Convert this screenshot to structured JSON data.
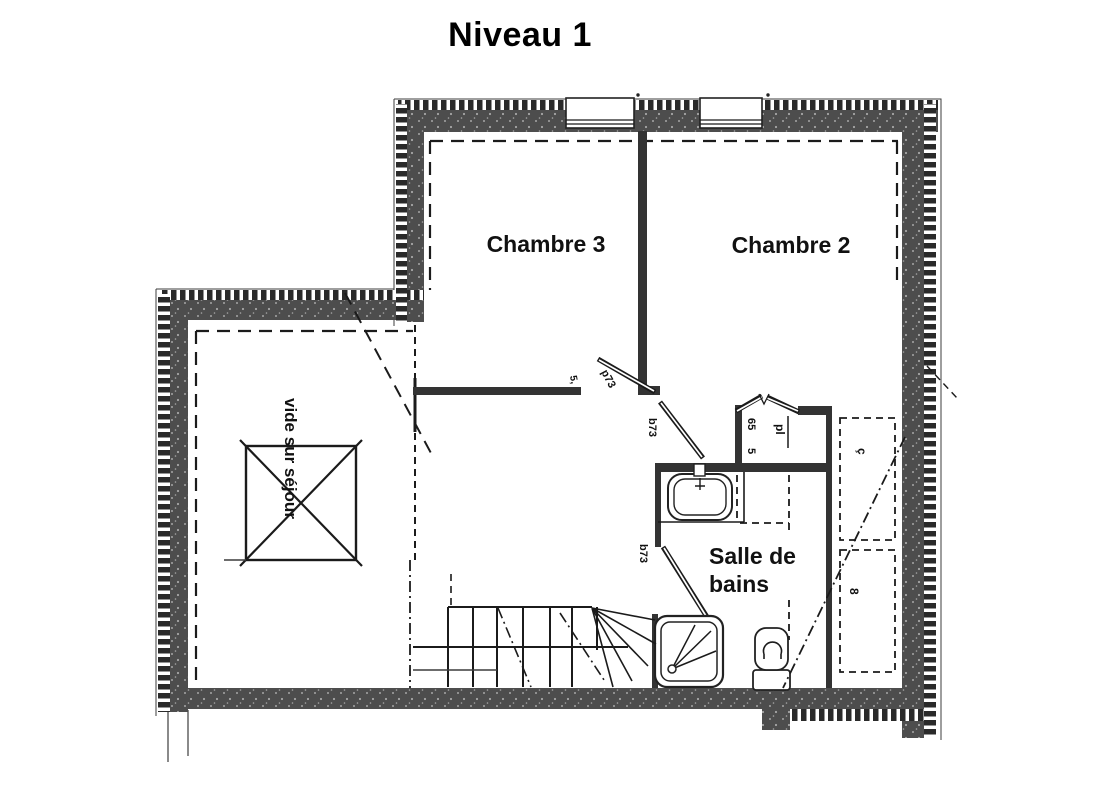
{
  "title": "Niveau 1",
  "rooms": {
    "chambre3": "Chambre 3",
    "chambre2": "Chambre 2",
    "salle_de_bains_line1": "Salle de",
    "salle_de_bains_line2": "bains",
    "vide_sur_sejour": "vide sur séjour"
  },
  "labels": {
    "door_chambre3": "p73",
    "door_chambre2": "b73",
    "door_bathroom": "b73",
    "dim_door_chambre3": "5,",
    "placard": "pl",
    "placard_dim_1": "65",
    "placard_dim_2": "5",
    "closet_label_top": "ç",
    "closet_label_bottom": "8"
  },
  "colors": {
    "wall_fill": "#4d4d4d",
    "line": "#1b1b1b",
    "ink": "#111111",
    "background": "#ffffff"
  }
}
